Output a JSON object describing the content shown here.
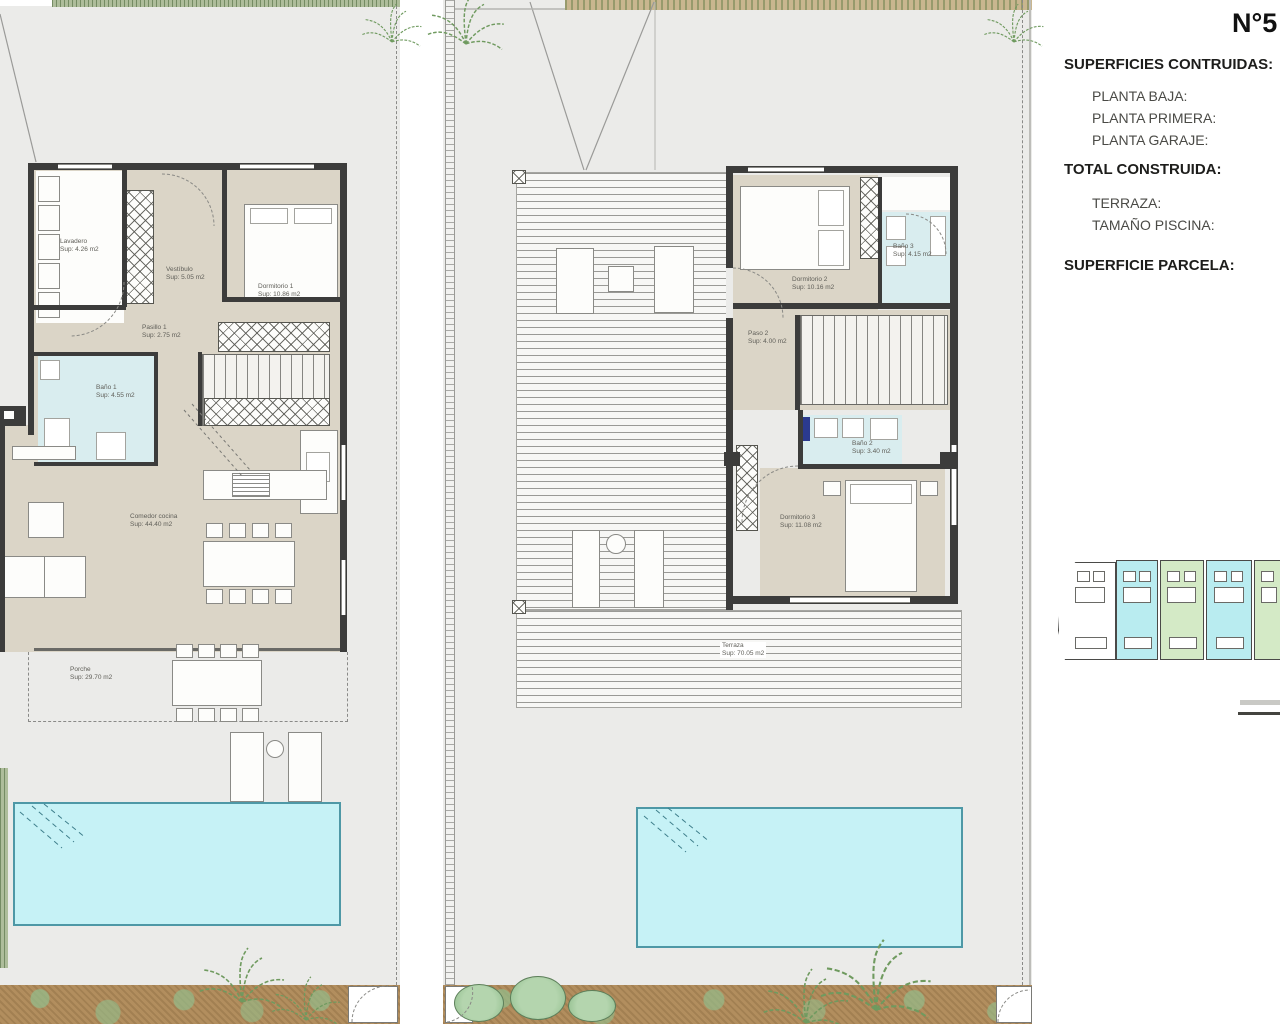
{
  "document": {
    "number": "N°5"
  },
  "panel": {
    "title": "SUPERFICIES CONTRUIDAS:",
    "planta_baja": "PLANTA BAJA:",
    "planta_primera": "PLANTA PRIMERA:",
    "planta_garaje": "PLANTA GARAJE:",
    "total": "TOTAL CONSTRUIDA:",
    "terraza": "TERRAZA:",
    "piscina": "TAMAÑO PISCINA:",
    "parcela": "SUPERFICIE PARCELA:"
  },
  "ground_floor": {
    "lavadero": {
      "name": "Lavadero",
      "area": "Sup: 4.26 m2"
    },
    "vestibulo": {
      "name": "Vestíbulo",
      "area": "Sup: 5.05 m2"
    },
    "dormitorio1": {
      "name": "Dormitorio 1",
      "area": "Sup: 10.86 m2"
    },
    "pasillo1": {
      "name": "Pasillo 1",
      "area": "Sup: 2.75 m2"
    },
    "bano1": {
      "name": "Baño 1",
      "area": "Sup: 4.55 m2"
    },
    "comedor": {
      "name": "Comedor cocina",
      "area": "Sup: 44.40 m2"
    },
    "porche": {
      "name": "Porche",
      "area": "Sup: 29.70 m2"
    }
  },
  "first_floor": {
    "dormitorio2": {
      "name": "Dormitorio 2",
      "area": "Sup: 10.16 m2"
    },
    "bano3": {
      "name": "Baño 3",
      "area": "Sup: 4.15 m2"
    },
    "paso2": {
      "name": "Paso 2",
      "area": "Sup: 4.00 m2"
    },
    "bano2": {
      "name": "Baño 2",
      "area": "Sup: 3.40 m2"
    },
    "dormitorio3": {
      "name": "Dormitorio 3",
      "area": "Sup: 11.08 m2"
    },
    "terraza": {
      "name": "Terraza",
      "area": "Sup: 70.05 m2"
    }
  },
  "colors": {
    "plot_gray": "#ebebe9",
    "floor_beige": "#dbd5c7",
    "wall_dark": "#3c3c3b",
    "bath_blue": "#d9edef",
    "pool_fill": "#c6f2f6",
    "pool_border": "#4e98a6",
    "garden_brown": "#b28e5e",
    "tree_green": "#8fbc8b",
    "site_unit_cyan": "#b9ecf0",
    "site_unit_green": "#d4eac6"
  },
  "site_plan": {
    "unit_colors": [
      "#ffffff",
      "#b9ecf0",
      "#d4eac6",
      "#b9ecf0",
      "#d4eac6"
    ]
  }
}
